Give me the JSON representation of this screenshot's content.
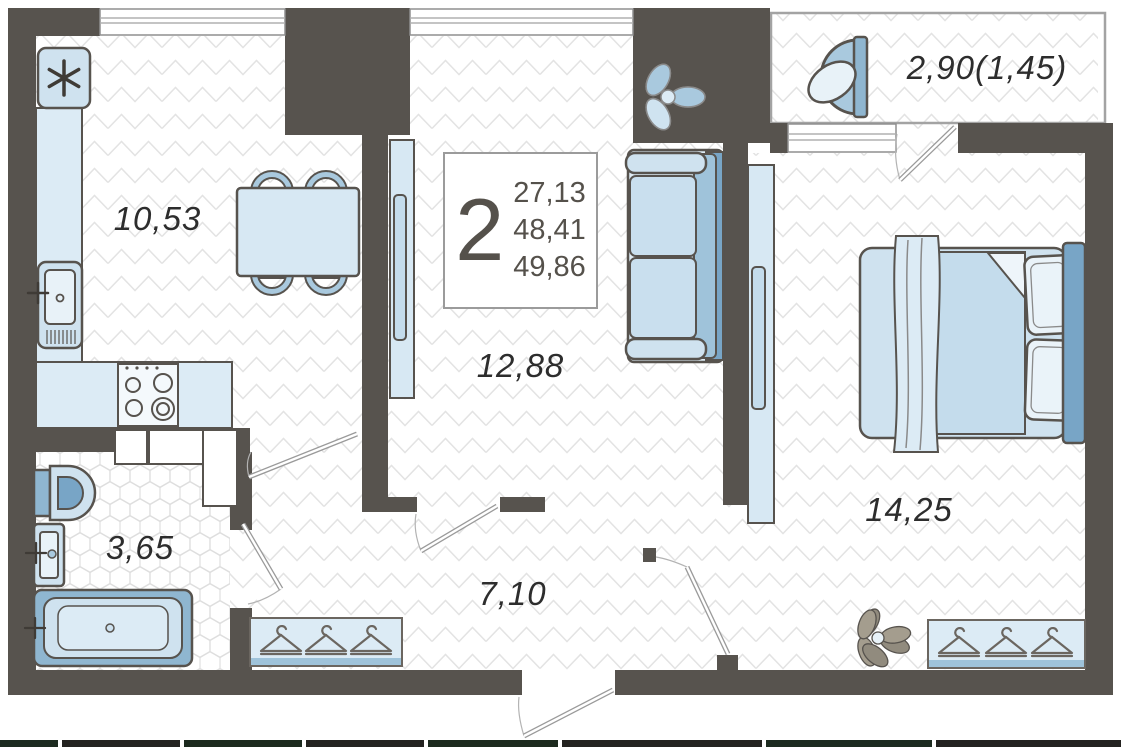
{
  "plan": {
    "title": "2-room apartment floor plan",
    "info_box": {
      "room_count": "2",
      "area_lines": [
        "27,13",
        "48,41",
        "49,86"
      ]
    },
    "rooms": {
      "kitchen": {
        "area": "10,53"
      },
      "living_room": {
        "area": "12,88"
      },
      "hallway": {
        "area": "7,10"
      },
      "bathroom": {
        "area": "3,65"
      },
      "bedroom": {
        "area": "14,25"
      },
      "balcony": {
        "area": "2,90(1,45)"
      }
    },
    "icons": {
      "fridge_symbol": "snowflake",
      "wardrobe_symbol": "clothes-hanger"
    },
    "colors": {
      "wall": "#57534e",
      "furniture_light": "#cfe2ef",
      "furniture_medium": "#8fb6d0",
      "furniture_dark": "#78a5c6",
      "floor_line": "#e3e3e3",
      "label_text": "#2d2d2d"
    }
  }
}
